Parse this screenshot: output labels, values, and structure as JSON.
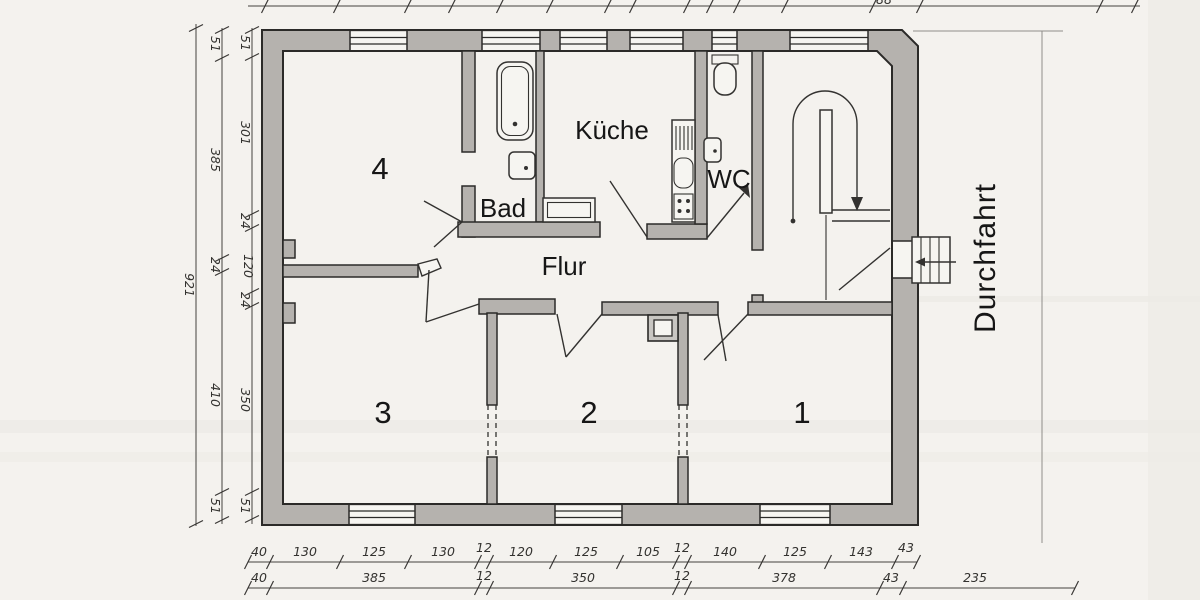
{
  "drawing": {
    "rooms": {
      "room4": "4",
      "room3": "3",
      "room2": "2",
      "room1": "1",
      "bad": "Bad",
      "kueche": "Küche",
      "wc": "WC",
      "flur": "Flur",
      "durchfahrt": "Durchfahrt"
    },
    "dims": {
      "left_inner": [
        "51",
        "301",
        "24",
        "120",
        "24",
        "350",
        "51"
      ],
      "left_middle": [
        "51",
        "385",
        "24",
        "410",
        "51"
      ],
      "left_total": "921",
      "bottom_upper": [
        "40",
        "130",
        "125",
        "130",
        "12",
        "120",
        "125",
        "105",
        "12",
        "140",
        "125",
        "143",
        "43"
      ],
      "bottom_lower": [
        "40",
        "385",
        "12",
        "350",
        "12",
        "378",
        "43",
        "235"
      ],
      "top_fragment": "88"
    },
    "colors": {
      "wall_fill": "#b5b2ae",
      "line": "#2b2a28",
      "paper": "#f4f2ee"
    }
  }
}
